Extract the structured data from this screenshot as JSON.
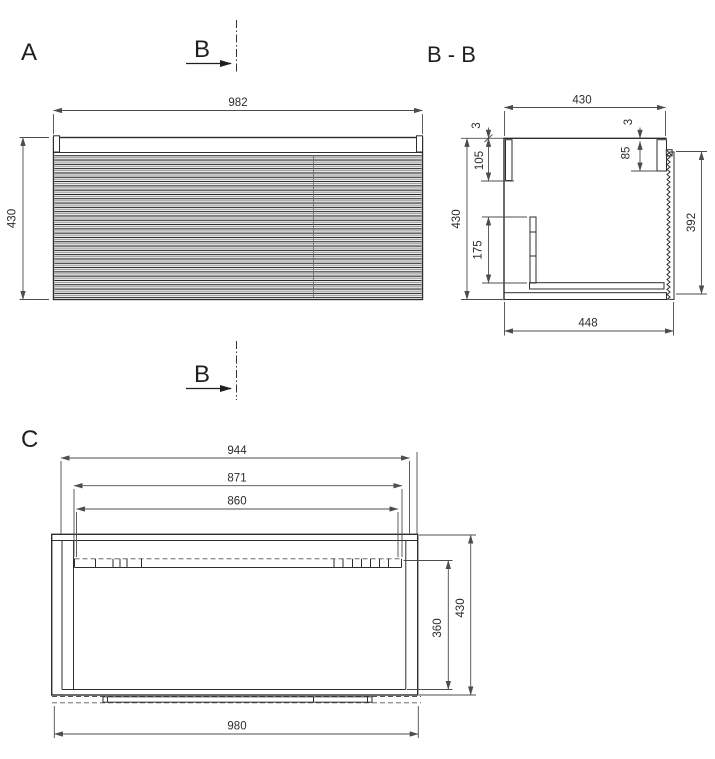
{
  "document_type": "technical-drawing",
  "colors": {
    "background": "#ffffff",
    "object_line": "#2d2d2d",
    "dimension_line": "#4d4d4d",
    "text": "#2b2b2b"
  },
  "labels": {
    "view_a": "A",
    "view_bb": "B - B",
    "view_c": "C",
    "section_marker": "B"
  },
  "front_view": {
    "width": "982",
    "height": "430"
  },
  "section_view": {
    "top_width": "430",
    "panel_thickness_left": "3",
    "back_panel_drop": "105",
    "panel_thickness_right": "3",
    "front_rail_drop": "85",
    "height": "430",
    "drawer_back_height": "175",
    "front_height": "392",
    "depth": "448"
  },
  "bottom_view": {
    "opening_width": "944",
    "slide_span_outer": "871",
    "slide_span_inner": "860",
    "inner_depth": "360",
    "depth": "430",
    "width": "980"
  }
}
